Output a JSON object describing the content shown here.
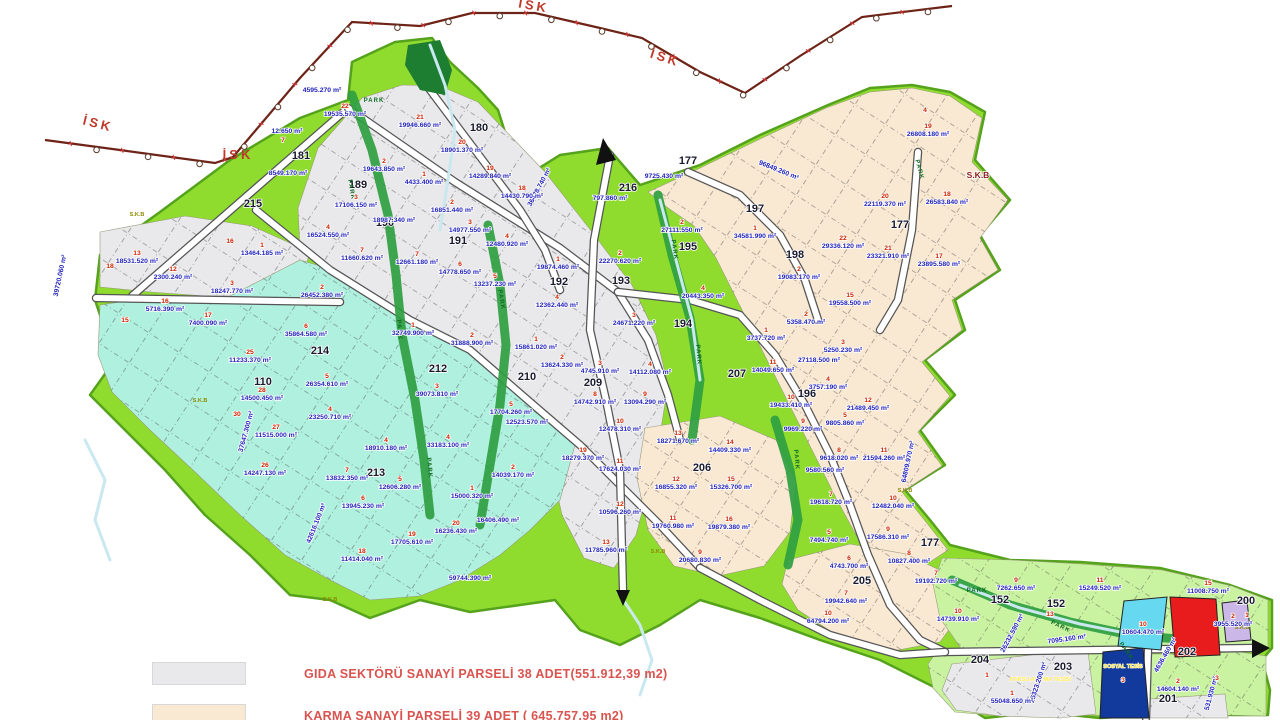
{
  "legend": {
    "items": [
      {
        "swatch": "#e9e9ec",
        "label": "GIDA SEKTÖRÜ SANAYİ PARSELİ 38 ADET(551.912,39 m2)"
      },
      {
        "swatch": "#f9e8d2",
        "label": "KARMA SANAYİ PARSELİ 39 ADET ( 645.757,95 m2)"
      }
    ]
  },
  "colors": {
    "belt_green": "#8fdc2f",
    "belt_edge": "#55a21c",
    "light_green_zone": "#c9f2a1",
    "teal_zone": "#b0f0df",
    "gray_zone": "#e9e9ec",
    "beige_zone": "#f9e8d2",
    "park_green": "#2f9e41",
    "river_blue": "#c9e8ef",
    "road_white": "#ffffff",
    "road_casing": "#555555",
    "red_parcel": "#e81c1c",
    "navy_parcel": "#123a9c",
    "cyan_parcel": "#66d9f0",
    "lavender_parcel": "#cbb8e8",
    "area_text_blue": "#2222bb",
    "parcel_num_red": "#cc2200",
    "zone_num_black": "#1a1a2e",
    "isk_line": "#6e2317",
    "isk_text_red": "#c03a2b",
    "park_text": "#116b22",
    "skb_olive": "#8a8a00",
    "skb_dark_red": "#8b1a1a",
    "legend_red": "#d9534f",
    "special_yellow": "#ffe84a"
  },
  "map": {
    "isk_labels": [
      {
        "t": "İSK",
        "x": 97,
        "y": 128,
        "r": 14
      },
      {
        "t": "İSK",
        "x": 238,
        "y": 159,
        "r": 0
      },
      {
        "t": "İSK",
        "x": 533,
        "y": 10,
        "r": 10
      },
      {
        "t": "İSK",
        "x": 664,
        "y": 62,
        "r": 18
      }
    ],
    "zone_labels": [
      {
        "t": "181",
        "x": 301,
        "y": 159
      },
      {
        "t": "189",
        "x": 358,
        "y": 188
      },
      {
        "t": "180",
        "x": 479,
        "y": 131
      },
      {
        "t": "190",
        "x": 385,
        "y": 226
      },
      {
        "t": "191",
        "x": 458,
        "y": 244
      },
      {
        "t": "215",
        "x": 253,
        "y": 207
      },
      {
        "t": "110",
        "x": 263,
        "y": 385
      },
      {
        "t": "212",
        "x": 438,
        "y": 372
      },
      {
        "t": "214",
        "x": 320,
        "y": 354
      },
      {
        "t": "210",
        "x": 527,
        "y": 380
      },
      {
        "t": "209",
        "x": 593,
        "y": 386
      },
      {
        "t": "213",
        "x": 376,
        "y": 476
      },
      {
        "t": "192",
        "x": 559,
        "y": 285
      },
      {
        "t": "193",
        "x": 621,
        "y": 284
      },
      {
        "t": "194",
        "x": 683,
        "y": 327
      },
      {
        "t": "195",
        "x": 688,
        "y": 250
      },
      {
        "t": "196",
        "x": 807,
        "y": 397
      },
      {
        "t": "197",
        "x": 755,
        "y": 212
      },
      {
        "t": "198",
        "x": 795,
        "y": 258
      },
      {
        "t": "177",
        "x": 688,
        "y": 164
      },
      {
        "t": "177",
        "x": 900,
        "y": 228
      },
      {
        "t": "177",
        "x": 930,
        "y": 546
      },
      {
        "t": "205",
        "x": 862,
        "y": 584
      },
      {
        "t": "206",
        "x": 702,
        "y": 471
      },
      {
        "t": "207",
        "x": 737,
        "y": 377
      },
      {
        "t": "200",
        "x": 1246,
        "y": 604
      },
      {
        "t": "201",
        "x": 1168,
        "y": 702
      },
      {
        "t": "202",
        "x": 1187,
        "y": 655
      },
      {
        "t": "203",
        "x": 1063,
        "y": 670
      },
      {
        "t": "204",
        "x": 980,
        "y": 663
      },
      {
        "t": "152",
        "x": 1000,
        "y": 603
      },
      {
        "t": "152",
        "x": 1056,
        "y": 607
      },
      {
        "t": "216",
        "x": 628,
        "y": 191
      }
    ],
    "park_labels": [
      {
        "x": 374,
        "y": 102,
        "r": 0
      },
      {
        "x": 350,
        "y": 190,
        "r": 80
      },
      {
        "x": 398,
        "y": 330,
        "r": 85
      },
      {
        "x": 428,
        "y": 468,
        "r": 85
      },
      {
        "x": 500,
        "y": 300,
        "r": 80
      },
      {
        "x": 673,
        "y": 250,
        "r": 82
      },
      {
        "x": 697,
        "y": 355,
        "r": 85
      },
      {
        "x": 918,
        "y": 170,
        "r": 75
      },
      {
        "x": 795,
        "y": 460,
        "r": 85
      },
      {
        "x": 977,
        "y": 592,
        "r": 0
      },
      {
        "x": 1060,
        "y": 628,
        "r": 25
      },
      {
        "x": 1125,
        "y": 652,
        "r": 55
      }
    ],
    "skb_main": {
      "t": "S.K.B",
      "x": 978,
      "y": 178
    },
    "skb_small": [
      {
        "x": 137,
        "y": 216
      },
      {
        "x": 200,
        "y": 402
      },
      {
        "x": 330,
        "y": 601
      },
      {
        "x": 658,
        "y": 553
      },
      {
        "x": 905,
        "y": 492
      },
      {
        "x": 1242,
        "y": 629
      }
    ],
    "special_labels": [
      {
        "t": "SOSYAL TESİS",
        "x": 1123,
        "y": 668
      },
      {
        "t": "ATIKSU ARITMA TESİSİ",
        "x": 1040,
        "y": 681
      }
    ],
    "edge_labels": [
      {
        "t": "39720.060 m²",
        "x": 62,
        "y": 276,
        "r": -78
      },
      {
        "t": "37647.300 m²",
        "x": 248,
        "y": 432,
        "r": -75
      },
      {
        "t": "42616.100 m²",
        "x": 318,
        "y": 524,
        "r": -68
      },
      {
        "t": "36478.740 m²",
        "x": 541,
        "y": 188,
        "r": -62
      },
      {
        "t": "96849.260 m²",
        "x": 778,
        "y": 172,
        "r": 22
      },
      {
        "t": "64809.970 m²",
        "x": 910,
        "y": 462,
        "r": -78
      },
      {
        "t": "26232.590 m²",
        "x": 1014,
        "y": 634,
        "r": -62
      },
      {
        "t": "25323.200 m²",
        "x": 1040,
        "y": 683,
        "r": -72
      },
      {
        "t": "531.930 m²",
        "x": 1213,
        "y": 694,
        "r": -75
      },
      {
        "t": "4636.460 m²",
        "x": 1167,
        "y": 656,
        "r": -60
      },
      {
        "t": "7095.160 m²",
        "x": 1067,
        "y": 641,
        "r": -8
      },
      {
        "t": "797.860 m²",
        "x": 610,
        "y": 200,
        "r": 0
      },
      {
        "t": "4595.270 m²",
        "x": 322,
        "y": 92,
        "r": 0
      },
      {
        "t": "8549.170 m²",
        "x": 288,
        "y": 175,
        "r": 0
      },
      {
        "t": "12.650 m²",
        "x": 287,
        "y": 133,
        "r": 0
      },
      {
        "t": "59744.390 m²",
        "x": 470,
        "y": 580,
        "r": 0
      }
    ],
    "parcels": [
      {
        "n": "22",
        "a": "19535.570 m²",
        "x": 345,
        "y": 116
      },
      {
        "n": "21",
        "a": "19946.660 m²",
        "x": 420,
        "y": 127
      },
      {
        "n": "20",
        "a": "18901.370 m²",
        "x": 462,
        "y": 152
      },
      {
        "n": "19",
        "a": "14289.840 m²",
        "x": 490,
        "y": 178
      },
      {
        "n": "18",
        "a": "14430.790 m²",
        "x": 522,
        "y": 198
      },
      {
        "n": "2",
        "a": "19643.850 m²",
        "x": 384,
        "y": 171
      },
      {
        "n": "1",
        "a": "4433.400 m²",
        "x": 424,
        "y": 184
      },
      {
        "n": "3",
        "a": "17106.150 m²",
        "x": 356,
        "y": 207
      },
      {
        "n": "",
        "a": "18987.340 m²",
        "x": 394,
        "y": 222
      },
      {
        "n": "4",
        "a": "16524.550 m²",
        "x": 328,
        "y": 237
      },
      {
        "n": "2",
        "a": "16851.440 m²",
        "x": 452,
        "y": 212
      },
      {
        "n": "3",
        "a": "14977.550 m²",
        "x": 470,
        "y": 232
      },
      {
        "n": "4",
        "a": "12480.920 m²",
        "x": 507,
        "y": 246
      },
      {
        "n": "7",
        "a": "11660.620 m²",
        "x": 362,
        "y": 260
      },
      {
        "n": "7",
        "a": "12661.180 m²",
        "x": 417,
        "y": 264
      },
      {
        "n": "6",
        "a": "14778.650 m²",
        "x": 460,
        "y": 274
      },
      {
        "n": "5",
        "a": "13237.230 m²",
        "x": 495,
        "y": 286
      },
      {
        "n": "1",
        "a": "19874.460 m²",
        "x": 558,
        "y": 269
      },
      {
        "n": "2",
        "a": "22270.620 m²",
        "x": 620,
        "y": 263
      },
      {
        "n": "4",
        "a": "12362.440 m²",
        "x": 557,
        "y": 307
      },
      {
        "n": "3",
        "a": "24671.220 m²",
        "x": 634,
        "y": 325
      },
      {
        "n": "1",
        "a": "15861.020 m²",
        "x": 536,
        "y": 349
      },
      {
        "n": "2",
        "a": "13624.330 m²",
        "x": 562,
        "y": 367
      },
      {
        "n": "3",
        "a": "4745.910 m²",
        "x": 600,
        "y": 373
      },
      {
        "n": "4",
        "a": "14112.080 m²",
        "x": 650,
        "y": 374
      },
      {
        "n": "8",
        "a": "14742.910 m²",
        "x": 595,
        "y": 404
      },
      {
        "n": "9",
        "a": "13094.290 m²",
        "x": 645,
        "y": 404
      },
      {
        "n": "5",
        "a": "17704.260 m²",
        "x": 511,
        "y": 414
      },
      {
        "n": "",
        "a": "12523.570 m²",
        "x": 527,
        "y": 424
      },
      {
        "n": "10",
        "a": "12478.310 m²",
        "x": 620,
        "y": 431
      },
      {
        "n": "19",
        "a": "18279.370 m²",
        "x": 583,
        "y": 460
      },
      {
        "n": "11",
        "a": "17624.030 m²",
        "x": 620,
        "y": 471
      },
      {
        "n": "12",
        "a": "10596.260 m²",
        "x": 620,
        "y": 514
      },
      {
        "n": "13",
        "a": "11785.960 m²",
        "x": 606,
        "y": 552
      },
      {
        "n": "13",
        "a": "18531.520 m²",
        "x": 137,
        "y": 263
      },
      {
        "n": "12",
        "a": "2300.240 m²",
        "x": 173,
        "y": 279
      },
      {
        "n": "1",
        "a": "13464.185 m²",
        "x": 262,
        "y": 255
      },
      {
        "n": "3",
        "a": "18247.770 m²",
        "x": 232,
        "y": 293
      },
      {
        "n": "2",
        "a": "26452.380 m²",
        "x": 322,
        "y": 297
      },
      {
        "n": "6",
        "a": "35864.580 m²",
        "x": 306,
        "y": 336
      },
      {
        "n": "1",
        "a": "32749.900 m²",
        "x": 413,
        "y": 335
      },
      {
        "n": "2",
        "a": "31888.900 m²",
        "x": 472,
        "y": 345
      },
      {
        "n": "25",
        "a": "11233.370 m²",
        "x": 250,
        "y": 362
      },
      {
        "n": "5",
        "a": "26354.610 m²",
        "x": 327,
        "y": 386
      },
      {
        "n": "3",
        "a": "39073.810 m²",
        "x": 437,
        "y": 396
      },
      {
        "n": "28",
        "a": "14500.450 m²",
        "x": 262,
        "y": 400
      },
      {
        "n": "4",
        "a": "23250.710 m²",
        "x": 330,
        "y": 419
      },
      {
        "n": "27",
        "a": "11515.000 m²",
        "x": 276,
        "y": 437
      },
      {
        "n": "4",
        "a": "18910.180 m²",
        "x": 386,
        "y": 450
      },
      {
        "n": "4",
        "a": "33183.100 m²",
        "x": 448,
        "y": 447
      },
      {
        "n": "26",
        "a": "14247.130 m²",
        "x": 265,
        "y": 475
      },
      {
        "n": "2",
        "a": "14039.170 m²",
        "x": 513,
        "y": 477
      },
      {
        "n": "7",
        "a": "13832.350 m²",
        "x": 347,
        "y": 480
      },
      {
        "n": "5",
        "a": "12606.280 m²",
        "x": 400,
        "y": 489
      },
      {
        "n": "1",
        "a": "15000.320 m²",
        "x": 472,
        "y": 498
      },
      {
        "n": "6",
        "a": "13945.230 m²",
        "x": 363,
        "y": 508
      },
      {
        "n": "",
        "a": "16406.490 m²",
        "x": 498,
        "y": 522
      },
      {
        "n": "20",
        "a": "16236.430 m²",
        "x": 456,
        "y": 533
      },
      {
        "n": "19",
        "a": "17705.610 m²",
        "x": 412,
        "y": 544
      },
      {
        "n": "18",
        "a": "11414.040 m²",
        "x": 362,
        "y": 561
      },
      {
        "n": "16",
        "a": "5716.390 m²",
        "x": 165,
        "y": 311
      },
      {
        "n": "17",
        "a": "7400.090 m²",
        "x": 208,
        "y": 325
      },
      {
        "n": "13",
        "a": "18271.670 m²",
        "x": 678,
        "y": 443
      },
      {
        "n": "14",
        "a": "14409.330 m²",
        "x": 730,
        "y": 452
      },
      {
        "n": "12",
        "a": "16855.320 m²",
        "x": 676,
        "y": 489
      },
      {
        "n": "15",
        "a": "15326.700 m²",
        "x": 731,
        "y": 489
      },
      {
        "n": "11",
        "a": "19760.980 m²",
        "x": 673,
        "y": 528
      },
      {
        "n": "16",
        "a": "19879.380 m²",
        "x": 729,
        "y": 529
      },
      {
        "n": "9",
        "a": "20680.830 m²",
        "x": 700,
        "y": 562
      },
      {
        "n": "7",
        "a": "19942.640 m²",
        "x": 846,
        "y": 603
      },
      {
        "n": "10",
        "a": "64794.200 m²",
        "x": 828,
        "y": 623
      },
      {
        "n": "",
        "a": "9725.430 m²",
        "x": 664,
        "y": 178
      },
      {
        "n": "2",
        "a": "27111.550 m²",
        "x": 682,
        "y": 232
      },
      {
        "n": "1",
        "a": "34581.990 m²",
        "x": 755,
        "y": 238
      },
      {
        "n": "4",
        "a": "20443.350 m²",
        "x": 703,
        "y": 298
      },
      {
        "n": "2",
        "a": "19083.170 m²",
        "x": 799,
        "y": 279
      },
      {
        "n": "22",
        "a": "29336.120 m²",
        "x": 843,
        "y": 248
      },
      {
        "n": "21",
        "a": "23321.910 m²",
        "x": 888,
        "y": 258
      },
      {
        "n": "20",
        "a": "22119.370 m²",
        "x": 885,
        "y": 206
      },
      {
        "n": "18",
        "a": "26583.840 m²",
        "x": 947,
        "y": 204
      },
      {
        "n": "17",
        "a": "23895.580 m²",
        "x": 939,
        "y": 266
      },
      {
        "n": "19",
        "a": "26808.180 m²",
        "x": 928,
        "y": 136
      },
      {
        "n": "15",
        "a": "19558.500 m²",
        "x": 850,
        "y": 305
      },
      {
        "n": "2",
        "a": "5358.470 m²",
        "x": 806,
        "y": 324
      },
      {
        "n": "1",
        "a": "3737.720 m²",
        "x": 766,
        "y": 340
      },
      {
        "n": "3",
        "a": "5250.230 m²",
        "x": 843,
        "y": 352
      },
      {
        "n": "",
        "a": "27118.500 m²",
        "x": 819,
        "y": 362
      },
      {
        "n": "11",
        "a": "14049.650 m²",
        "x": 773,
        "y": 372
      },
      {
        "n": "4",
        "a": "3757.190 m²",
        "x": 828,
        "y": 389
      },
      {
        "n": "10",
        "a": "19433.410 m²",
        "x": 791,
        "y": 407
      },
      {
        "n": "12",
        "a": "21489.450 m²",
        "x": 868,
        "y": 410
      },
      {
        "n": "5",
        "a": "9805.860 m²",
        "x": 845,
        "y": 425
      },
      {
        "n": "9",
        "a": "9969.220 m²",
        "x": 803,
        "y": 431
      },
      {
        "n": "8",
        "a": "9618.020 m²",
        "x": 839,
        "y": 460
      },
      {
        "n": "",
        "a": "9580.560 m²",
        "x": 825,
        "y": 472
      },
      {
        "n": "11",
        "a": "21594.260 m²",
        "x": 884,
        "y": 460
      },
      {
        "n": "7",
        "a": "19618.720 m²",
        "x": 831,
        "y": 504
      },
      {
        "n": "10",
        "a": "12482.040 m²",
        "x": 893,
        "y": 508
      },
      {
        "n": "5",
        "a": "7494.740 m²",
        "x": 829,
        "y": 542
      },
      {
        "n": "9",
        "a": "17586.310 m²",
        "x": 888,
        "y": 539
      },
      {
        "n": "6",
        "a": "4743.700 m²",
        "x": 849,
        "y": 568
      },
      {
        "n": "8",
        "a": "10827.400 m²",
        "x": 909,
        "y": 563
      },
      {
        "n": "7",
        "a": "19192.720 m²",
        "x": 936,
        "y": 583
      },
      {
        "n": "9",
        "a": "7262.650 m²",
        "x": 1016,
        "y": 590
      },
      {
        "n": "11",
        "a": "15249.520 m²",
        "x": 1100,
        "y": 590
      },
      {
        "n": "15",
        "a": "11008.750 m²",
        "x": 1208,
        "y": 593
      },
      {
        "n": "10",
        "a": "14739.910 m²",
        "x": 958,
        "y": 621
      },
      {
        "n": "10",
        "a": "10604.470 m²",
        "x": 1143,
        "y": 634
      },
      {
        "n": "2",
        "a": "3955.520 m²",
        "x": 1233,
        "y": 626
      },
      {
        "n": "2",
        "a": "14604.140 m²",
        "x": 1178,
        "y": 691
      },
      {
        "n": "1",
        "a": "55048.650 m²",
        "x": 1012,
        "y": 703
      }
    ],
    "loose_nums": [
      {
        "t": "7",
        "x": 283,
        "y": 142
      },
      {
        "t": "4",
        "x": 925,
        "y": 112
      },
      {
        "t": "16",
        "x": 230,
        "y": 243
      },
      {
        "t": "15",
        "x": 125,
        "y": 322
      },
      {
        "t": "18",
        "x": 110,
        "y": 268
      },
      {
        "t": "30",
        "x": 237,
        "y": 416
      },
      {
        "t": "13",
        "x": 1050,
        "y": 616
      },
      {
        "t": "1",
        "x": 1247,
        "y": 617
      },
      {
        "t": "3",
        "x": 1123,
        "y": 682
      },
      {
        "t": "3",
        "x": 1217,
        "y": 680
      },
      {
        "t": "1",
        "x": 987,
        "y": 677
      }
    ]
  }
}
